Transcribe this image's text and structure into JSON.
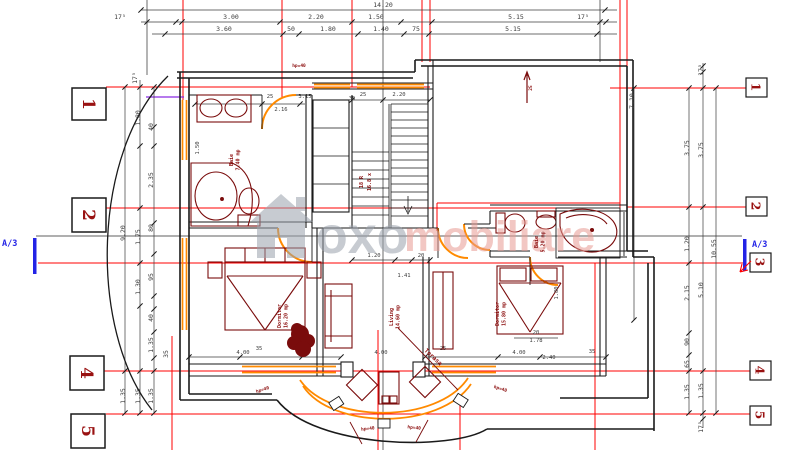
{
  "watermark": {
    "word1": "oxo",
    "word2": "mobiliare"
  },
  "section_label_left": "A/3",
  "section_label_right": "A/3",
  "grid_markers_left": [
    "1",
    "2",
    "4",
    "5"
  ],
  "grid_markers_right": [
    "1",
    "2",
    "3",
    "4",
    "5"
  ],
  "dims_top_row1": [
    "14.20"
  ],
  "dims_top_row2": [
    "17⁵",
    "3.00",
    "2.20",
    "1.50",
    "5.15",
    "17⁵"
  ],
  "dims_top_row3": [
    "3.60",
    "50",
    "1.80",
    "1.40",
    "75",
    "5.15"
  ],
  "dims_left": [
    "17⁵",
    "9.20",
    "1.80",
    "2.35",
    "40",
    "80",
    "1.75",
    "95",
    "1.30",
    "40",
    "1.35",
    "35",
    "1.35",
    "1.35",
    "1.35"
  ],
  "dims_right": [
    "7.10",
    "17⁵",
    "3.75",
    "3.75",
    "1.20",
    "10.55",
    "2.15",
    "5.10",
    "90",
    "65",
    "1.35",
    "1.35",
    "17⁵"
  ],
  "dims_inner": [
    "25",
    "3.15",
    "35",
    "2.16",
    "1.50",
    "25",
    "2.20",
    "20",
    "1.78",
    "1.80",
    "1.41",
    "1.20",
    "20",
    "4.00",
    "35",
    "4.00",
    "25",
    "4.00",
    "2.40",
    "35"
  ],
  "stair_note": [
    "18 R",
    "16.8 x"
  ],
  "room_labels": [
    {
      "name": "Baie",
      "area": "7.40 mp"
    },
    {
      "name": "Dormitor",
      "area": "16.20 mp"
    },
    {
      "name": "Living",
      "area": "14.60 mp"
    },
    {
      "name": "Dormitor",
      "area": "15.80 mp"
    },
    {
      "name": "Baie",
      "area": "5.20 mp"
    }
  ],
  "terrace_label": "Terasa",
  "window_notes": [
    "hp=40",
    "hp=40",
    "hp=40",
    "hp=40",
    "hp=40"
  ],
  "arrow_note": "25",
  "colors": {
    "grid_red": "#ff0000",
    "wall_black": "#1a1a1a",
    "furniture_red": "#7a0c0c",
    "window_orange": "#ff8a00",
    "marker_blue": "#2323e6",
    "watermark_gray": "#9aa2ac",
    "watermark_pink": "#e89b93",
    "marker_number_red": "#991111",
    "annotation_purple": "#8a2be2"
  }
}
